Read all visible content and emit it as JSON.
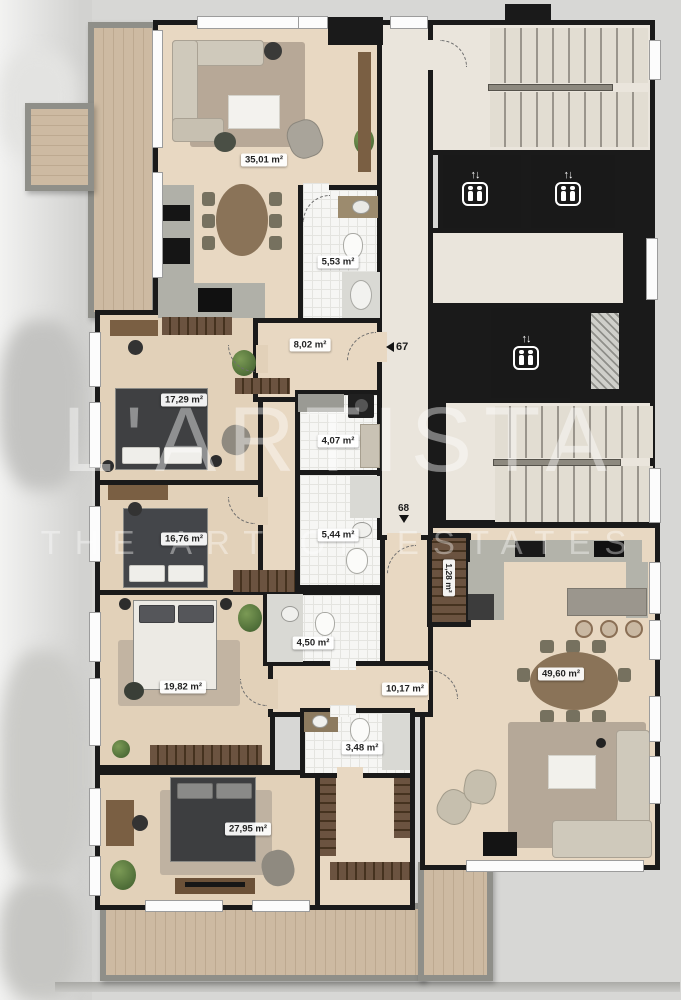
{
  "title": "Apartment floor plan",
  "watermark": {
    "line1": "L'ARTISTA",
    "line2": "THE ART OF ESTATES"
  },
  "markers": {
    "apt67": {
      "number": "67",
      "direction": "left"
    },
    "apt68": {
      "number": "68",
      "direction": "down"
    }
  },
  "icons": {
    "elevator_arrows": "↑↓"
  },
  "rooms": [
    {
      "id": "living-dining-67",
      "area": "35,01 m²"
    },
    {
      "id": "bathroom-67",
      "area": "5,53 m²"
    },
    {
      "id": "hall-67",
      "area": "8,02 m²"
    },
    {
      "id": "bedroom-67-1",
      "area": "17,29 m²"
    },
    {
      "id": "laundry-67",
      "area": "4,07 m²"
    },
    {
      "id": "bathroom-67-2",
      "area": "5,44 m²"
    },
    {
      "id": "bedroom-67-2",
      "area": "16,76 m²"
    },
    {
      "id": "closet-68",
      "area": "1,28 m²"
    },
    {
      "id": "bathroom-68",
      "area": "4,50 m²"
    },
    {
      "id": "bedroom-68-1",
      "area": "19,82 m²"
    },
    {
      "id": "hall-68",
      "area": "10,17 m²"
    },
    {
      "id": "wc-68",
      "area": "3,48 m²"
    },
    {
      "id": "bedroom-68-2",
      "area": "27,95 m²"
    },
    {
      "id": "living-dining-68",
      "area": "49,60 m²"
    }
  ],
  "colors": {
    "wall": "#1a1a1a",
    "wood_floor": "#e8d8c2",
    "marble_floor": "#eae5dc",
    "deck": "#cdbaa2",
    "parapet": "#8f8f89",
    "tile": "#f6f6f4",
    "label_bg": "#ffffff",
    "elevator_shaft": "#191919"
  }
}
